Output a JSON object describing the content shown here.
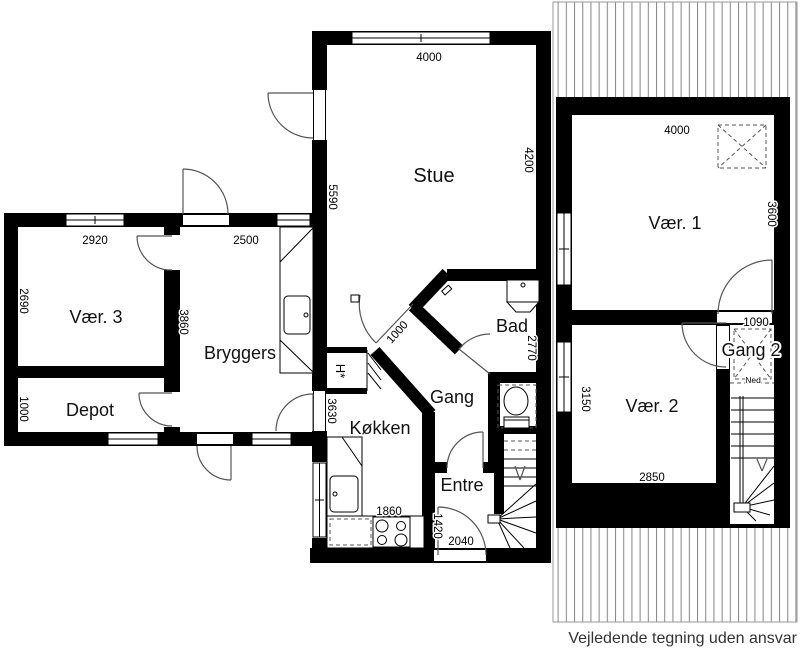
{
  "plan": {
    "rooms": {
      "stue": "Stue",
      "vaer1": "Vær. 1",
      "vaer2": "Vær. 2",
      "vaer3": "Vær. 3",
      "bryggers": "Bryggers",
      "depot": "Depot",
      "koekken": "Køkken",
      "gang": "Gang",
      "gang2": "Gang 2",
      "bad": "Bad",
      "entre": "Entre",
      "closet": "H*"
    },
    "dims": {
      "stue_w": "4000",
      "stue_side": "5590",
      "stue_right": "4200",
      "vaer3_w": "2920",
      "vaer3_h": "2690",
      "bryggers_w": "2500",
      "bryggers_side": "3860",
      "depot_h": "1000",
      "koekken_side": "3630",
      "koekken_w": "1860",
      "gang_opening": "1000",
      "bad_h": "2770",
      "entre_h": "1420",
      "entre_w": "2040",
      "vaer1_w": "4000",
      "vaer1_h": "3600",
      "gang2_w": "1090",
      "vaer2_h": "3150",
      "vaer2_w": "2850"
    },
    "notes": {
      "stairs_down": "Ned",
      "disclaimer": "Vejledende tegning uden ansvar"
    },
    "colors": {
      "wall": "#000000",
      "hatch": "#8a8a8a"
    }
  }
}
